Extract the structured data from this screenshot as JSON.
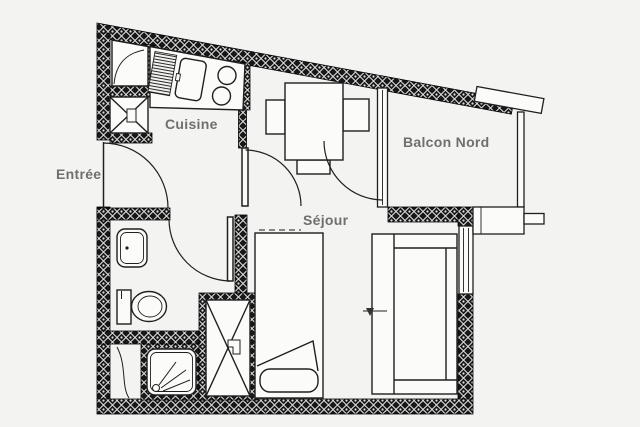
{
  "page": {
    "background": "#f3f3f1"
  },
  "colors": {
    "wall": "#171717",
    "wall_pattern_light": "#e2e2e2",
    "line": "#1f1f1f",
    "label": "#6f6f6f",
    "fixture_fill": "#fbfbf9"
  },
  "rooms": {
    "entree": {
      "label": "Entrée"
    },
    "cuisine": {
      "label": "Cuisine"
    },
    "sejour": {
      "label": "Séjour"
    },
    "balcon_nord": {
      "label": "Balcon Nord"
    }
  }
}
